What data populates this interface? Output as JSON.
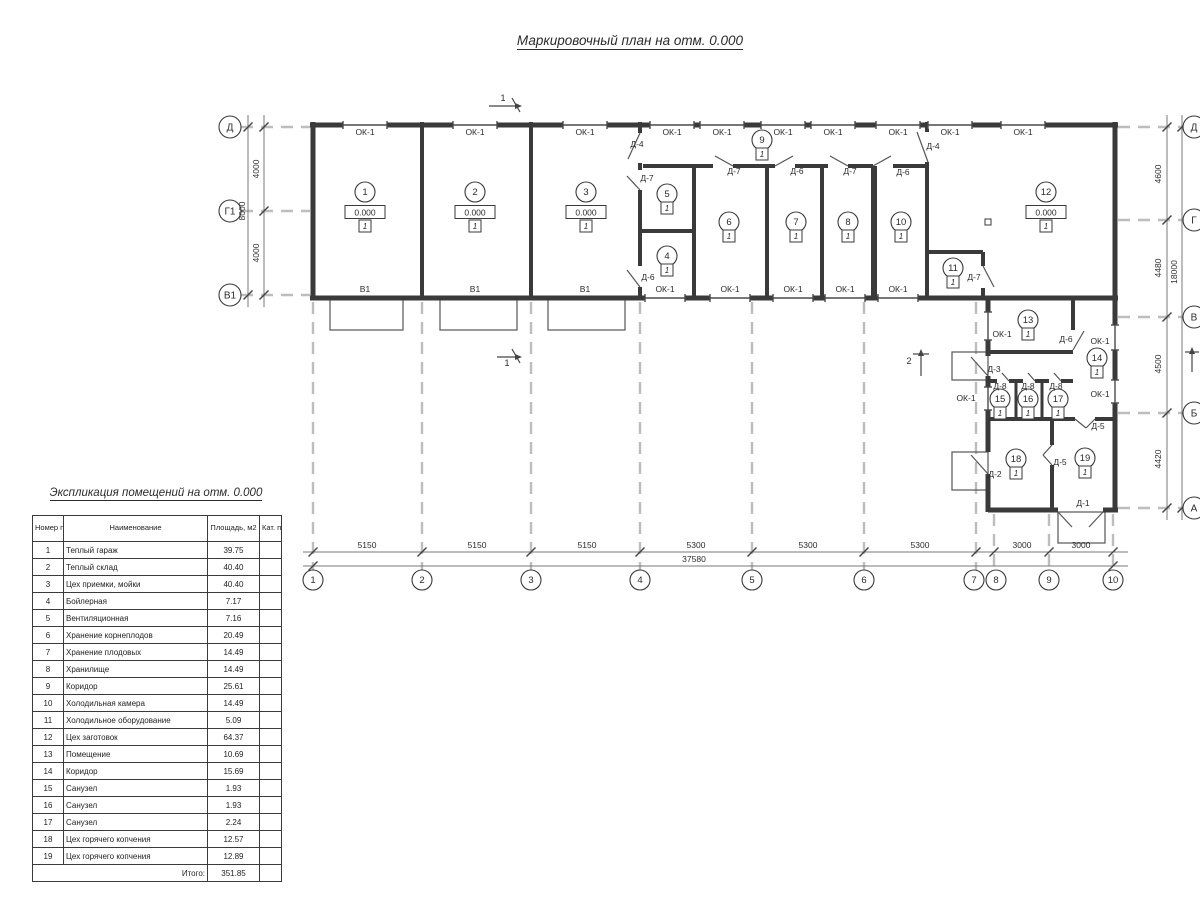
{
  "plan_title": "Маркировочный план на отм. 0.000",
  "colors": {
    "ink": "#3a3a3a",
    "thin": "#555555",
    "dash": "#bdbdbd",
    "dim": "#787878",
    "bg": "#ffffff"
  },
  "table": {
    "title": "Экспликация помещений на отм. 0.000",
    "headers": [
      "Номер помещ.",
      "Наименование",
      "Площадь, м2",
      "Кат. пом."
    ],
    "rows": [
      [
        "1",
        "Теплый гараж",
        "39.75",
        ""
      ],
      [
        "2",
        "Теплый склад",
        "40.40",
        ""
      ],
      [
        "3",
        "Цех приемки, мойки",
        "40.40",
        ""
      ],
      [
        "4",
        "Бойлерная",
        "7.17",
        ""
      ],
      [
        "5",
        "Вентиляционная",
        "7.16",
        ""
      ],
      [
        "6",
        "Хранение корнеплодов",
        "20.49",
        ""
      ],
      [
        "7",
        "Хранение плодовых",
        "14.49",
        ""
      ],
      [
        "8",
        "Хранилище",
        "14.49",
        ""
      ],
      [
        "9",
        "Коридор",
        "25.61",
        ""
      ],
      [
        "10",
        "Холодильная камера",
        "14.49",
        ""
      ],
      [
        "11",
        "Холодильное оборудование",
        "5.09",
        ""
      ],
      [
        "12",
        "Цех заготовок",
        "64.37",
        ""
      ],
      [
        "13",
        "Помещение",
        "10.69",
        ""
      ],
      [
        "14",
        "Коридор",
        "15.69",
        ""
      ],
      [
        "15",
        "Санузел",
        "1.93",
        ""
      ],
      [
        "16",
        "Санузел",
        "1.93",
        ""
      ],
      [
        "17",
        "Санузел",
        "2.24",
        ""
      ],
      [
        "18",
        "Цех горячего копчения",
        "12.57",
        ""
      ],
      [
        "19",
        "Цех горячего копчения",
        "12.89",
        ""
      ]
    ],
    "total_label": "Итого:",
    "total_value": "351.85"
  },
  "plan": {
    "floor_mark": "1",
    "walls": [
      [
        310,
        125,
        1118,
        125,
        5
      ],
      [
        313,
        122,
        313,
        300,
        5
      ],
      [
        310,
        298,
        1118,
        298,
        5
      ],
      [
        1115,
        122,
        1115,
        512,
        5
      ],
      [
        988,
        298,
        988,
        356,
        5
      ],
      [
        988,
        376,
        988,
        452,
        5
      ],
      [
        988,
        474,
        988,
        512,
        5
      ],
      [
        988,
        510,
        1058,
        510,
        5
      ],
      [
        1103,
        510,
        1118,
        510,
        5
      ],
      [
        422,
        122,
        422,
        298,
        4
      ],
      [
        531,
        122,
        531,
        298,
        4
      ],
      [
        640,
        122,
        640,
        133,
        4
      ],
      [
        640,
        163,
        640,
        170,
        4
      ],
      [
        640,
        190,
        640,
        266,
        4
      ],
      [
        640,
        287,
        640,
        298,
        4
      ],
      [
        643,
        166,
        713,
        166,
        4
      ],
      [
        733,
        166,
        775,
        166,
        4
      ],
      [
        795,
        166,
        828,
        166,
        4
      ],
      [
        848,
        166,
        873,
        166,
        4
      ],
      [
        893,
        166,
        927,
        166,
        4
      ],
      [
        694,
        166,
        694,
        298,
        4
      ],
      [
        640,
        231,
        694,
        231,
        4
      ],
      [
        767,
        166,
        767,
        298,
        4
      ],
      [
        822,
        166,
        822,
        298,
        4
      ],
      [
        874,
        166,
        874,
        298,
        6
      ],
      [
        927,
        122,
        927,
        132,
        4
      ],
      [
        927,
        162,
        927,
        298,
        4
      ],
      [
        927,
        252,
        983,
        252,
        4
      ],
      [
        983,
        252,
        983,
        266,
        4
      ],
      [
        983,
        288,
        983,
        298,
        4
      ],
      [
        1073,
        298,
        1073,
        330,
        4
      ],
      [
        988,
        352,
        1073,
        352,
        4
      ],
      [
        988,
        381,
        997,
        381,
        4
      ],
      [
        1009,
        381,
        1023,
        381,
        4
      ],
      [
        1035,
        381,
        1049,
        381,
        4
      ],
      [
        1061,
        381,
        1073,
        381,
        4
      ],
      [
        1016,
        381,
        1016,
        419,
        3
      ],
      [
        1042,
        381,
        1042,
        419,
        3
      ],
      [
        988,
        419,
        1075,
        419,
        4
      ],
      [
        1095,
        419,
        1115,
        419,
        4
      ],
      [
        1052,
        419,
        1052,
        445,
        4
      ],
      [
        1052,
        465,
        1052,
        512,
        4
      ]
    ],
    "thin_lines": [
      [
        640,
        133,
        628,
        159
      ],
      [
        640,
        190,
        627,
        176
      ],
      [
        640,
        287,
        627,
        270
      ],
      [
        733,
        166,
        715,
        156
      ],
      [
        775,
        166,
        793,
        156
      ],
      [
        848,
        166,
        830,
        156
      ],
      [
        873,
        166,
        891,
        156
      ],
      [
        917,
        132,
        928,
        162
      ],
      [
        983,
        266,
        994,
        287
      ],
      [
        1073,
        350,
        1084,
        331
      ],
      [
        988,
        376,
        971,
        357
      ],
      [
        988,
        474,
        971,
        455
      ],
      [
        1009,
        381,
        1002,
        373
      ],
      [
        1035,
        381,
        1028,
        373
      ],
      [
        1061,
        381,
        1054,
        373
      ],
      [
        1075,
        419,
        1086,
        428
      ],
      [
        1095,
        419,
        1086,
        428
      ],
      [
        1052,
        445,
        1043,
        455
      ],
      [
        1052,
        465,
        1043,
        455
      ],
      [
        1058,
        512,
        1072,
        527
      ],
      [
        1103,
        512,
        1089,
        527
      ]
    ],
    "windows": [
      [
        343,
        125,
        387,
        125
      ],
      [
        453,
        125,
        497,
        125
      ],
      [
        563,
        125,
        607,
        125
      ],
      [
        650,
        125,
        694,
        125
      ],
      [
        700,
        125,
        744,
        125
      ],
      [
        761,
        125,
        805,
        125
      ],
      [
        811,
        125,
        855,
        125
      ],
      [
        876,
        125,
        920,
        125
      ],
      [
        928,
        125,
        972,
        125
      ],
      [
        1001,
        125,
        1045,
        125
      ],
      [
        645,
        298,
        685,
        298
      ],
      [
        710,
        298,
        750,
        298
      ],
      [
        773,
        298,
        813,
        298
      ],
      [
        825,
        298,
        865,
        298
      ],
      [
        878,
        298,
        918,
        298
      ],
      [
        988,
        312,
        988,
        340
      ],
      [
        988,
        387,
        988,
        410
      ],
      [
        1115,
        325,
        1115,
        350
      ],
      [
        1115,
        380,
        1115,
        403
      ]
    ],
    "dashes": [
      [
        313,
        302,
        313,
        570
      ],
      [
        422,
        302,
        422,
        570
      ],
      [
        531,
        302,
        531,
        570
      ],
      [
        640,
        302,
        640,
        570
      ],
      [
        752,
        302,
        752,
        570
      ],
      [
        864,
        302,
        864,
        570
      ],
      [
        976,
        302,
        976,
        570
      ],
      [
        994,
        514,
        994,
        570
      ],
      [
        1049,
        514,
        1049,
        570
      ],
      [
        1113,
        514,
        1113,
        570
      ],
      [
        241,
        127,
        310,
        127
      ],
      [
        241,
        211,
        310,
        211
      ],
      [
        241,
        295,
        310,
        295
      ],
      [
        1118,
        127,
        1183,
        127
      ],
      [
        1118,
        220,
        1183,
        220
      ],
      [
        1118,
        317,
        1183,
        317
      ],
      [
        1118,
        413,
        1183,
        413
      ],
      [
        1118,
        508,
        1183,
        508
      ]
    ],
    "dim_lines": [
      [
        303,
        552,
        1128,
        552
      ],
      [
        303,
        566,
        1128,
        566
      ],
      [
        248,
        115,
        248,
        307
      ],
      [
        264,
        115,
        264,
        307
      ],
      [
        1167,
        115,
        1167,
        520
      ],
      [
        1182,
        115,
        1182,
        520
      ]
    ],
    "ticks": [
      [
        313,
        552
      ],
      [
        422,
        552
      ],
      [
        531,
        552
      ],
      [
        640,
        552
      ],
      [
        752,
        552
      ],
      [
        864,
        552
      ],
      [
        976,
        552
      ],
      [
        994,
        552
      ],
      [
        1049,
        552
      ],
      [
        1113,
        552
      ],
      [
        313,
        566
      ],
      [
        1113,
        566
      ],
      [
        264,
        127
      ],
      [
        264,
        211
      ],
      [
        264,
        295
      ],
      [
        248,
        127
      ],
      [
        248,
        295
      ],
      [
        1167,
        127
      ],
      [
        1167,
        220
      ],
      [
        1167,
        317
      ],
      [
        1167,
        413
      ],
      [
        1167,
        508
      ],
      [
        1182,
        127
      ],
      [
        1182,
        508
      ]
    ],
    "rects": [
      [
        330,
        299,
        73,
        31
      ],
      [
        440,
        299,
        77,
        31
      ],
      [
        548,
        299,
        77,
        31
      ],
      [
        952,
        352,
        36,
        28
      ],
      [
        952,
        452,
        36,
        38
      ],
      [
        1058,
        512,
        47,
        31
      ]
    ],
    "squares": [
      [
        988,
        222
      ]
    ],
    "rooms": [
      {
        "n": "1",
        "x": 365,
        "y": 192,
        "e": "0.000"
      },
      {
        "n": "2",
        "x": 475,
        "y": 192,
        "e": "0.000"
      },
      {
        "n": "3",
        "x": 586,
        "y": 192,
        "e": "0.000"
      },
      {
        "n": "5",
        "x": 667,
        "y": 194
      },
      {
        "n": "4",
        "x": 667,
        "y": 256
      },
      {
        "n": "6",
        "x": 729,
        "y": 222
      },
      {
        "n": "7",
        "x": 796,
        "y": 222
      },
      {
        "n": "8",
        "x": 848,
        "y": 222
      },
      {
        "n": "9",
        "x": 762,
        "y": 140
      },
      {
        "n": "10",
        "x": 901,
        "y": 222
      },
      {
        "n": "11",
        "x": 953,
        "y": 268
      },
      {
        "n": "12",
        "x": 1046,
        "y": 192,
        "e": "0.000"
      },
      {
        "n": "13",
        "x": 1028,
        "y": 320
      },
      {
        "n": "14",
        "x": 1097,
        "y": 358
      },
      {
        "n": "15",
        "x": 1000,
        "y": 399
      },
      {
        "n": "16",
        "x": 1028,
        "y": 399
      },
      {
        "n": "17",
        "x": 1058,
        "y": 399
      },
      {
        "n": "18",
        "x": 1016,
        "y": 459
      },
      {
        "n": "19",
        "x": 1085,
        "y": 458
      }
    ],
    "labels": [
      [
        "ОК-1",
        365,
        132
      ],
      [
        "ОК-1",
        475,
        132
      ],
      [
        "ОК-1",
        585,
        132
      ],
      [
        "ОК-1",
        672,
        132
      ],
      [
        "ОК-1",
        722,
        132
      ],
      [
        "ОК-1",
        783,
        132
      ],
      [
        "ОК-1",
        833,
        132
      ],
      [
        "ОК-1",
        898,
        132
      ],
      [
        "ОК-1",
        950,
        132
      ],
      [
        "ОК-1",
        1023,
        132
      ],
      [
        "В1",
        365,
        289
      ],
      [
        "В1",
        475,
        289
      ],
      [
        "В1",
        585,
        289
      ],
      [
        "ОК-1",
        665,
        289
      ],
      [
        "ОК-1",
        730,
        289
      ],
      [
        "ОК-1",
        793,
        289
      ],
      [
        "ОК-1",
        845,
        289
      ],
      [
        "ОК-1",
        898,
        289
      ],
      [
        "ОК-1",
        1002,
        334
      ],
      [
        "ОК-1",
        1100,
        341
      ],
      [
        "ОК-1",
        966,
        398
      ],
      [
        "ОК-1",
        1100,
        394
      ],
      [
        "Д-4",
        637,
        144
      ],
      [
        "Д-7",
        647,
        178
      ],
      [
        "Д-7",
        734,
        171
      ],
      [
        "Д-6",
        797,
        171
      ],
      [
        "Д-7",
        850,
        171
      ],
      [
        "Д-6",
        648,
        277
      ],
      [
        "Д-4",
        933,
        146
      ],
      [
        "Д-6",
        903,
        172
      ],
      [
        "Д-7",
        974,
        277
      ],
      [
        "Д-6",
        1066,
        339
      ],
      [
        "Д-3",
        994,
        369
      ],
      [
        "Д-8",
        1000,
        386
      ],
      [
        "Д-8",
        1028,
        386
      ],
      [
        "Д-8",
        1056,
        386
      ],
      [
        "Д-5",
        1098,
        426
      ],
      [
        "Д-2",
        995,
        474
      ],
      [
        "Д-5",
        1060,
        462
      ],
      [
        "Д-1",
        1083,
        503
      ]
    ],
    "axes": {
      "bottom": [
        [
          "1",
          313
        ],
        [
          "2",
          422
        ],
        [
          "3",
          531
        ],
        [
          "4",
          640
        ],
        [
          "5",
          752
        ],
        [
          "6",
          864
        ],
        [
          "7",
          974
        ],
        [
          "8",
          996
        ],
        [
          "9",
          1049
        ],
        [
          "10",
          1113
        ]
      ],
      "left": [
        [
          "Д",
          127
        ],
        [
          "Г1",
          211
        ],
        [
          "В1",
          295
        ]
      ],
      "right": [
        [
          "Д",
          127
        ],
        [
          "Г",
          220
        ],
        [
          "В",
          317
        ],
        [
          "Б",
          413
        ],
        [
          "А",
          508
        ]
      ]
    },
    "dims": {
      "bottom": [
        [
          "5150",
          367
        ],
        [
          "5150",
          477
        ],
        [
          "5150",
          587
        ],
        [
          "5300",
          696
        ],
        [
          "5300",
          808
        ],
        [
          "5300",
          920
        ],
        [
          "3000",
          1022
        ],
        [
          "3000",
          1081
        ]
      ],
      "bottom_total": [
        "37580",
        694
      ],
      "left": [
        [
          "4000",
          169
        ],
        [
          "4000",
          253
        ]
      ],
      "left_total": [
        "8000",
        211
      ],
      "right": [
        [
          "4600",
          174
        ],
        [
          "4480",
          268
        ],
        [
          "4500",
          364
        ],
        [
          "4420",
          459
        ]
      ],
      "right_total": [
        "18000",
        272
      ]
    },
    "marks": [
      {
        "t": "1",
        "tx": 503,
        "ty": 101,
        "lines": [
          [
            489,
            106,
            515,
            106
          ],
          [
            512,
            98,
            520,
            112
          ]
        ],
        "ax": 515,
        "ay": 106,
        "dir": "r"
      },
      {
        "t": "1",
        "tx": 507,
        "ty": 366,
        "lines": [
          [
            497,
            357,
            515,
            357
          ],
          [
            512,
            349,
            520,
            363
          ]
        ],
        "ax": 515,
        "ay": 357,
        "dir": "r"
      },
      {
        "t": "2",
        "tx": 909,
        "ty": 364,
        "lines": [
          [
            921,
            376,
            921,
            356
          ],
          [
            913,
            354,
            929,
            354
          ]
        ],
        "ax": 921,
        "ay": 356,
        "dir": "u"
      },
      {
        "t": "",
        "tx": 0,
        "ty": 0,
        "lines": [
          [
            1192,
            372,
            1192,
            354
          ],
          [
            1185,
            352,
            1199,
            352
          ]
        ],
        "ax": 1192,
        "ay": 354,
        "dir": "u"
      }
    ]
  }
}
